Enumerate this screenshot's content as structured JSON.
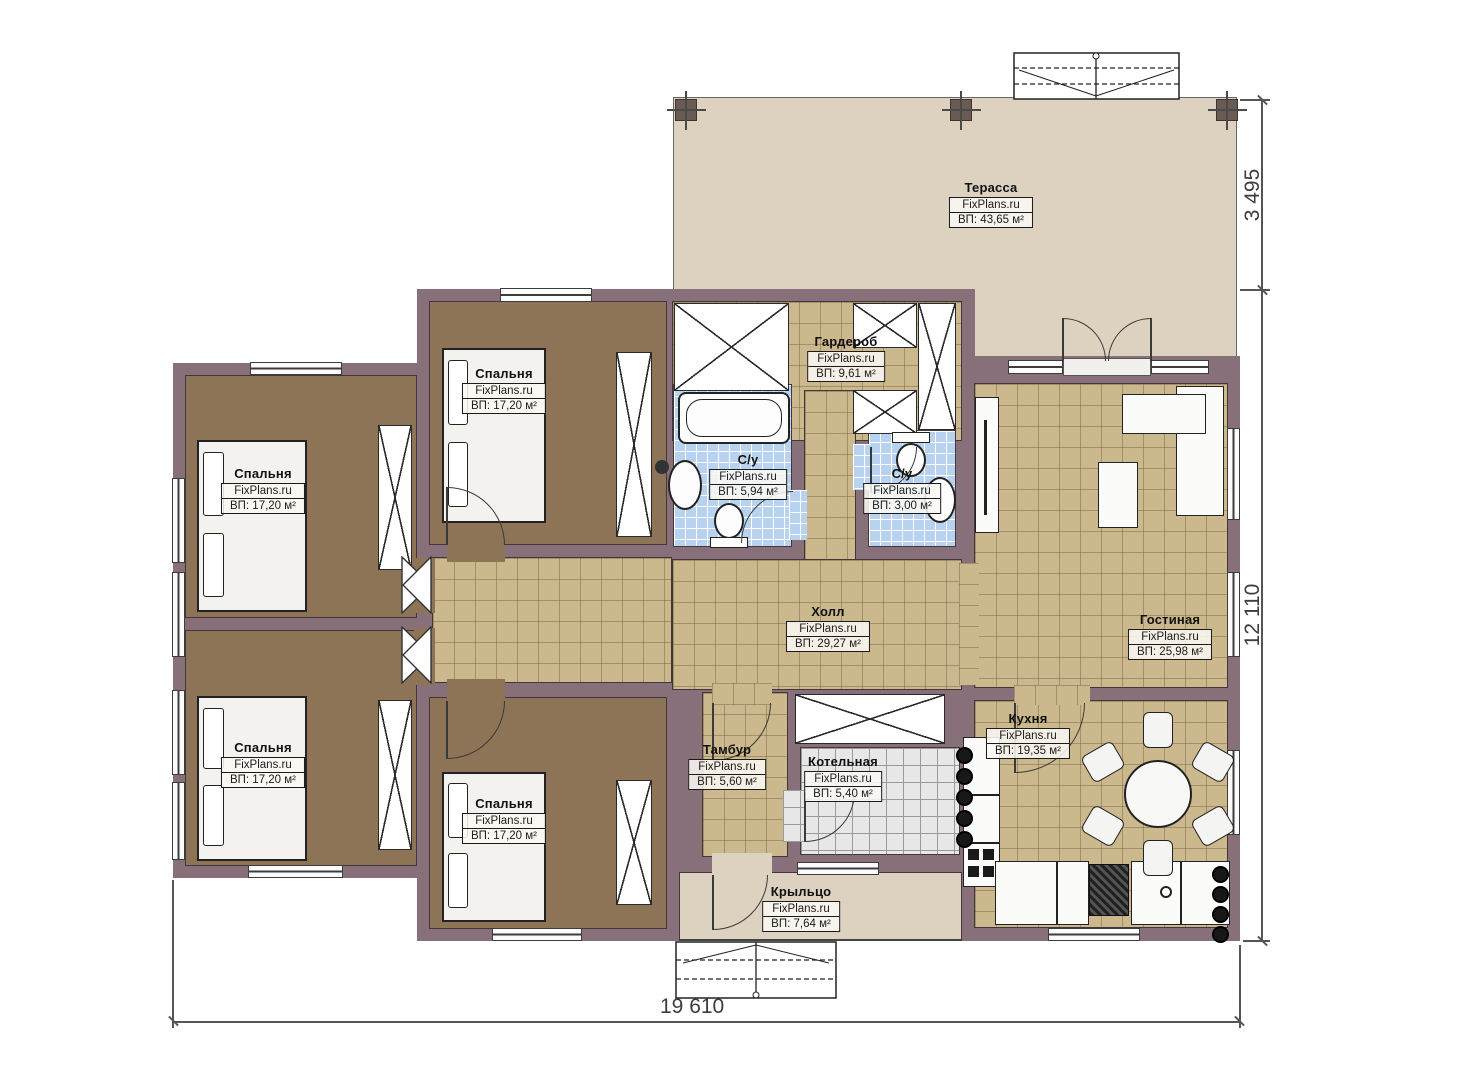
{
  "plan": {
    "brand": "FixPlans.ru",
    "dimensions": {
      "terrace_depth": "3 495",
      "house_depth": "12 110",
      "house_width": "19 610"
    },
    "colors": {
      "wall": "#877079",
      "bedroom_floor": "#8d7456",
      "tile_floor": "#cbb88c",
      "bathroom_tile": "#b7d3ef",
      "boiler_tile": "#e7e7e7",
      "deck": "#dcd2bf"
    },
    "rooms": [
      {
        "id": "terrace",
        "name": "Терасса",
        "site": "FixPlans.ru",
        "area": "ВП: 43,65 м²"
      },
      {
        "id": "bedroom-top-left",
        "name": "Спальня",
        "site": "FixPlans.ru",
        "area": "ВП: 17,20 м²"
      },
      {
        "id": "bedroom-top-middle",
        "name": "Спальня",
        "site": "FixPlans.ru",
        "area": "ВП: 17,20 м²"
      },
      {
        "id": "bedroom-bottom-left",
        "name": "Спальня",
        "site": "FixPlans.ru",
        "area": "ВП: 17,20 м²"
      },
      {
        "id": "bedroom-bottom-middle",
        "name": "Спальня",
        "site": "FixPlans.ru",
        "area": "ВП: 17,20 м²"
      },
      {
        "id": "wardrobe",
        "name": "Гардероб",
        "site": "FixPlans.ru",
        "area": "ВП: 9,61 м²"
      },
      {
        "id": "bathroom-big",
        "name": "С/у",
        "site": "FixPlans.ru",
        "area": "ВП: 5,94 м²"
      },
      {
        "id": "bathroom-small",
        "name": "С/у",
        "site": "FixPlans.ru",
        "area": "ВП: 3,00 м²"
      },
      {
        "id": "hall",
        "name": "Холл",
        "site": "FixPlans.ru",
        "area": "ВП: 29,27 м²"
      },
      {
        "id": "living-room",
        "name": "Гостиная",
        "site": "FixPlans.ru",
        "area": "ВП: 25,98 м²"
      },
      {
        "id": "kitchen",
        "name": "Кухня",
        "site": "FixPlans.ru",
        "area": "ВП: 19,35 м²"
      },
      {
        "id": "vestibule",
        "name": "Тамбур",
        "site": "FixPlans.ru",
        "area": "ВП: 5,60 м²"
      },
      {
        "id": "boiler-room",
        "name": "Котельная",
        "site": "FixPlans.ru",
        "area": "ВП: 5,40 м²"
      },
      {
        "id": "porch",
        "name": "Крыльцо",
        "site": "FixPlans.ru",
        "area": "ВП: 7,64 м²"
      }
    ]
  }
}
